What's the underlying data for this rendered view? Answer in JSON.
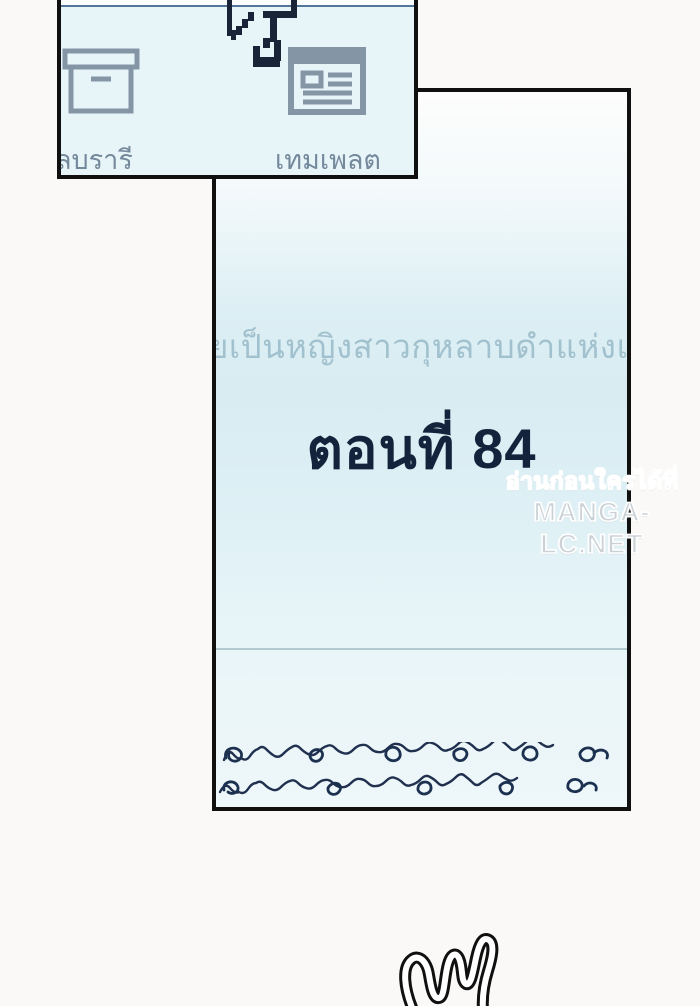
{
  "toolbar": {
    "items": [
      {
        "label": "ลบรารี",
        "icon": "archive-box-icon"
      },
      {
        "label": "เทมเพลต",
        "icon": "template-window-icon"
      }
    ]
  },
  "panel": {
    "series_title": "ยเป็นหญิงสาวกุหลาบดำแห่งแวร์ซาย",
    "episode_label": "ตอนที่ 84"
  },
  "watermark": {
    "line1": "อ่านก่อนใครได้ที่",
    "line2": "MANGA-LC.NET"
  },
  "colors": {
    "page_background": "#faf9f7",
    "panel_background": "#e7f4f8",
    "panel_border": "#101010",
    "icon": "#8496a6",
    "toolbar_label": "#75899c",
    "accent_line": "#54769a",
    "series_title_text": "#a2c1ce",
    "episode_text": "#13233b",
    "divider": "#b2cbd1",
    "handwriting": "#1e3050",
    "watermark_text": "#cbd2d7",
    "cursor": "#1a2439"
  }
}
